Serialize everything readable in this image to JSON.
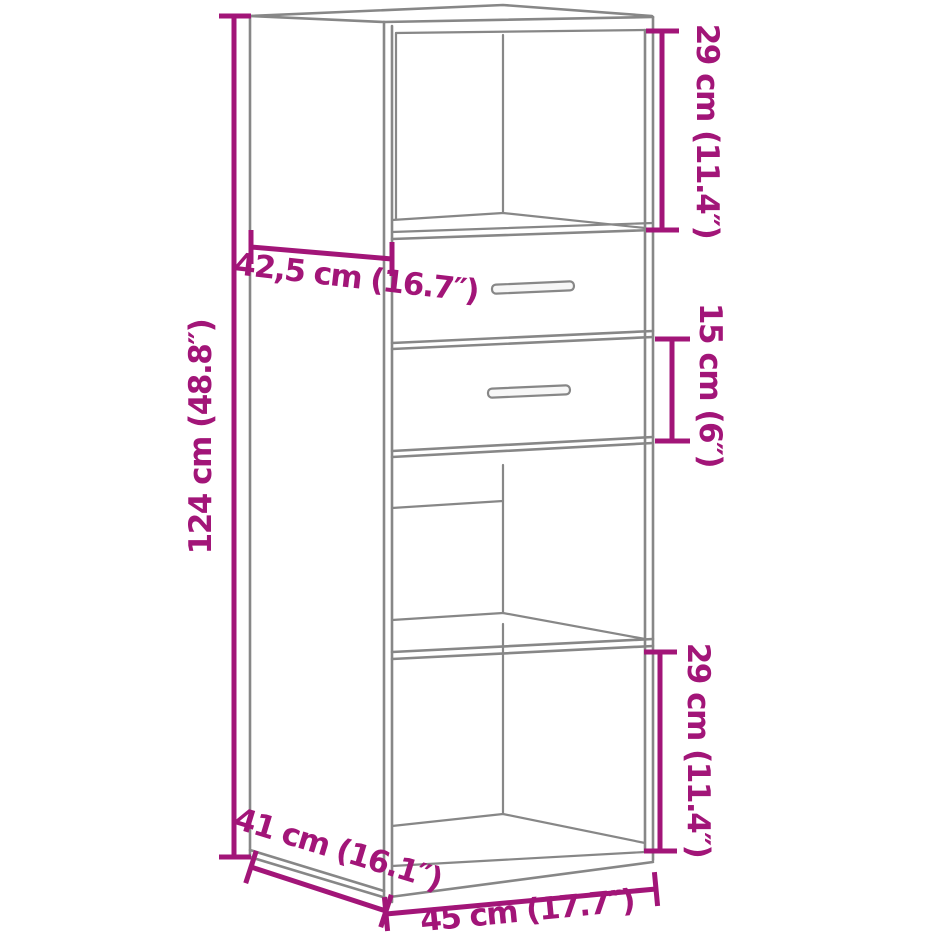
{
  "diagram": {
    "kind": "furniture-dimension-diagram",
    "subject": "highboard-cabinet-with-2-drawers",
    "colors": {
      "dimension": "#A21578",
      "outline": "#878787",
      "background": "#ffffff"
    },
    "dimensions": [
      {
        "id": "upper-compartment-height",
        "label": "29 cm (11.4″)"
      },
      {
        "id": "top-depth",
        "label": "42,5 cm (16.7″)"
      },
      {
        "id": "overall-height",
        "label": "124 cm (48.8″)"
      },
      {
        "id": "drawer-height",
        "label": "15 cm (6″)"
      },
      {
        "id": "lower-compartment-height",
        "label": "29 cm (11.4″)"
      },
      {
        "id": "depth",
        "label": "41 cm (16.1″)"
      },
      {
        "id": "width",
        "label": "45 cm (17.7″)"
      }
    ]
  }
}
